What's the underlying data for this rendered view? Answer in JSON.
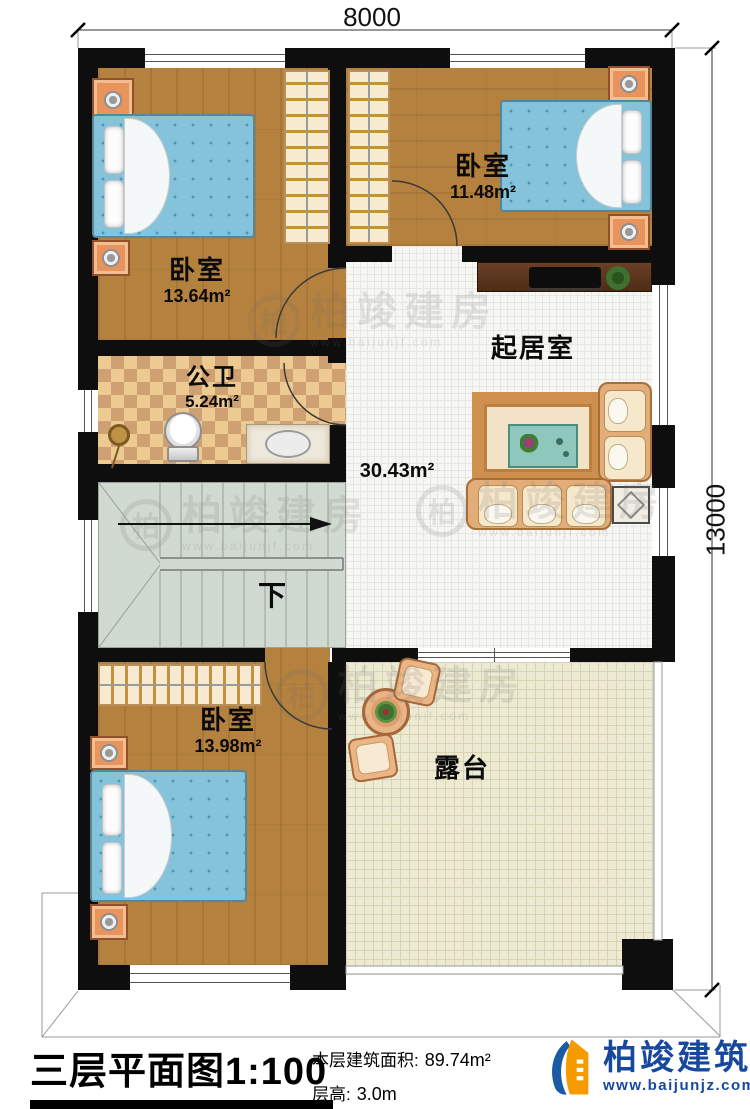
{
  "dimensions": {
    "width": "8000",
    "height": "13000"
  },
  "rooms": {
    "bedroom_top_left": {
      "name": "卧室",
      "area": "13.64m²"
    },
    "bedroom_top_right": {
      "name": "卧室",
      "area": "11.48m²"
    },
    "bathroom": {
      "name": "公卫",
      "area": "5.24m²"
    },
    "living_room": {
      "name": "起居室",
      "area": "30.43m²"
    },
    "bedroom_bottom": {
      "name": "卧室",
      "area": "13.98m²"
    },
    "terrace": {
      "name": "露台"
    },
    "stairs": {
      "down_label": "下"
    }
  },
  "title_block": {
    "title": "三层平面图1:100",
    "floor_area_label": "本层建筑面积:",
    "floor_area_value": "89.74m²",
    "floor_height_label": "层高:",
    "floor_height_value": "3.0m"
  },
  "branding": {
    "company": "柏竣建筑",
    "website": "www.baijunjz.com"
  },
  "watermark": {
    "logo_char": "柏",
    "text": "柏竣建房",
    "website": "www.baijunjf.com"
  },
  "colors": {
    "wall": "#0e0e0e",
    "wood_floor": "#b5813f",
    "bed_blue": "#85c3da",
    "brand_blue": "#17489e",
    "brand_orange": "#f59b00"
  }
}
